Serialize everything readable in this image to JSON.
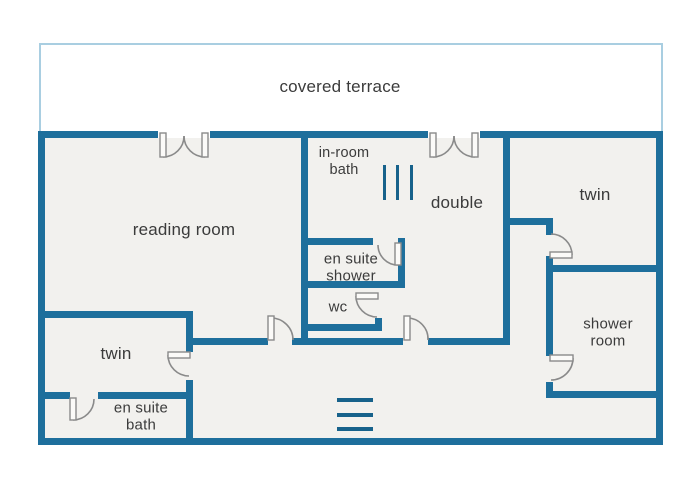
{
  "terrace": {
    "label": "covered terrace"
  },
  "rooms": {
    "reading_room": {
      "label": "reading room"
    },
    "in_room_bath": {
      "label": "in-room bath"
    },
    "double": {
      "label": "double"
    },
    "twin_top": {
      "label": "twin"
    },
    "en_suite_shower": {
      "label": "en suite shower"
    },
    "wc": {
      "label": "wc"
    },
    "twin_bottom": {
      "label": "twin"
    },
    "en_suite_bath": {
      "label": "en suite bath"
    },
    "shower_room": {
      "label": "shower room"
    }
  },
  "colors": {
    "wall": "#1e6f9c",
    "floor": "#f2f1ee",
    "terrace_border": "#a9cee1",
    "terrace_fill": "#ffffff",
    "door_line": "#8a8a8a",
    "label_text": "#3b3b3b",
    "symbol": "#17628b"
  }
}
